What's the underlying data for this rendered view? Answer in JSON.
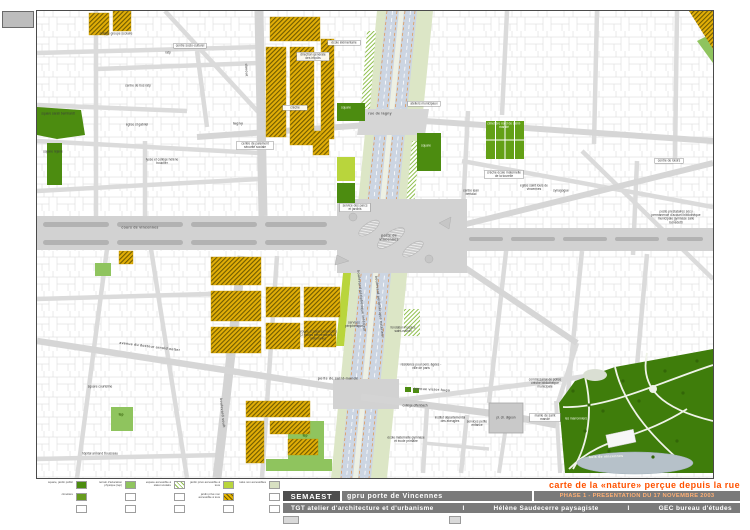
{
  "colors": {
    "accent": "#ff5200",
    "bar_gray": "#7a7a7a",
    "bar_dark": "#4e4e4e",
    "phase_text": "#ffb075",
    "park_green": "#3f7d0b",
    "square_green": "#4c8c10",
    "tep_green": "#8fc45e",
    "private_garden": "#b9d53c",
    "talus": "#d8e0c2",
    "hatch_yellow": "#e6b400",
    "lake": "#b6c1c9"
  },
  "titleblock": {
    "title": "carte de la «nature» perçue depuis la rue",
    "client": "SEMAEST",
    "project": "gpru porte de Vincennes",
    "phase": "PHASE 1 - PRESENTATION DU 17 NOVEMBRE 2003",
    "team_architect": "TGT  atelier d'architecture et d'urbanisme",
    "team_landscape": "Hélène Saudecerre  paysagiste",
    "team_engineer": "GEC  bureau d'études",
    "sep": "I"
  },
  "legend": {
    "rows": [
      {
        "cells": [
          {
            "label": "square, jardin public",
            "type": "g1"
          },
          {
            "label": "terrain d'éducation physique (tep)",
            "type": "g2"
          },
          {
            "label": "espace accessible à statut scolaire",
            "type": "hg"
          },
          {
            "label": "jardin privé accessible à tous",
            "type": "g3"
          },
          {
            "label": "talus non accessibles",
            "type": "g4"
          }
        ]
      },
      {
        "cells": [
          {
            "label": "cimetière",
            "type": "g5"
          },
          {
            "label": "",
            "type": "none"
          },
          {
            "label": "",
            "type": "none"
          },
          {
            "label": "jardin privé non accessible à tous",
            "type": "hy"
          },
          {
            "label": "",
            "type": "none"
          }
        ]
      },
      {
        "cells": [
          {
            "label": "",
            "type": "none"
          },
          {
            "label": "",
            "type": "none"
          },
          {
            "label": "",
            "type": "none"
          },
          {
            "label": "",
            "type": "none"
          },
          {
            "label": "",
            "type": "none"
          }
        ]
      }
    ]
  },
  "map": {
    "labels": {
      "sarah": "square sarah bernhardt",
      "rejane": "square réjane",
      "gabriel": "église st gabriel",
      "boucher": "lycée et collège hélène boucher",
      "college_gs": "collège groupe scolaire",
      "ratp": "ratp",
      "socio": "centre socio-culturel",
      "bus_ratp": "centre de bus ratp",
      "impots": "direction générale des impôts",
      "ecole_elem": "école élémentaire",
      "creche": "crèche",
      "paiement": "centre de paiement sécurité sociale",
      "lagny_short": "lagny",
      "rue_lagny": "rue de lagny",
      "davout": "davout",
      "square_w": "square",
      "square_e": "square",
      "ateliers": "ateliers municipaux",
      "cimetiere": "cimetière nord de saint-mandé",
      "tourelle": "crèche école maternelle de la tourelle",
      "bertaud": "centre jean bertaud",
      "st_louis": "église saint louis de vincennes",
      "synagogue": "synagogue",
      "loisirs": "centre de loisirs",
      "poste_bloc": "poste prestataires sécu permanence d'accueil bibliothèque municipale gymnase salle bénédetti",
      "porte_vincennes": "porte de vincennes",
      "parcs_jardins": "service des parcs et jardins",
      "lamoriciere": "groupe scolaire lamoricière (2 écoles élémentaires, 1 maternelle)",
      "services_periph": "services périphérique",
      "periph_int": "boulevard périphérique intérieur",
      "periph_ext": "boulevard périphérique extérieur",
      "porte_st_mande": "porte de saint-mandé",
      "fondation": "fondation hospice saint-michel",
      "res_agees": "résidence pour pers. âgées - ville de paris",
      "victor_hugo": "avenue victor hugo",
      "offenbach": "collège offenbach",
      "aveugles": "institut départemental des aveugles",
      "mat_prim": "école maternelle gymnase et école primaire",
      "petite_enfance": "services petite enfance",
      "digeon": "pl. ch. digeon",
      "mairie_sm": "mairie de saint mandé",
      "commissariat": "commissariat de police crèche bibliothèque municipale",
      "marronniers": "les marronniers",
      "bois_vincennes": "bois de vincennes",
      "trousseau": "hôpital armand trousseau",
      "netter": "avenue du docteur arnold netter",
      "courteline": "square courteline",
      "tep1": "tep",
      "soult": "boulevard soult",
      "tep2": "tep",
      "cours": "cours de vincennes"
    }
  }
}
